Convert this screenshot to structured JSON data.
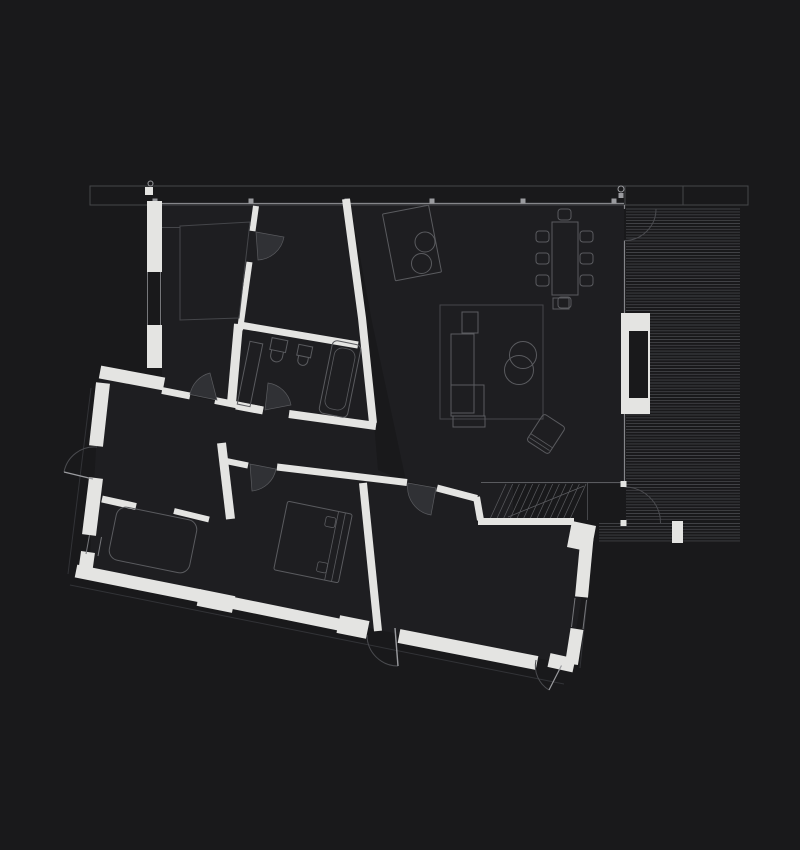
{
  "scene": {
    "kind": "architectural-floor-plan",
    "width": 800,
    "height": 850,
    "style": "dark background, white walls, thin grey furniture outlines, no text labels"
  },
  "palette": {
    "background": "#19191b",
    "floor": "#1e1e21",
    "wall": "#e4e4e2",
    "furniture_line": "#5a5b5f",
    "faint_line": "#45464a",
    "glass_line": "#85868a",
    "window_line": "#76777b",
    "door_arc": "#4a4b4f",
    "door_leaf_fill": "#303135",
    "deck_board": "#404145",
    "mullion": "#9a9b9f",
    "overhang_line": "#323337"
  },
  "glazing": {
    "mullion_xs": [
      155,
      251,
      347,
      432,
      523,
      614
    ],
    "mullion_y": 201,
    "mullion_size": 5
  },
  "deck": {
    "boards_upper": {
      "x0": 626,
      "x1": 740,
      "y0": 209,
      "y1": 520,
      "step": 2.9
    },
    "boards_lower": {
      "x0": 599,
      "x1": 740,
      "y0": 523.5,
      "y1": 542.5,
      "step": 2.9
    }
  },
  "stairs": {
    "x0": 506,
    "x1": 586,
    "y_top": 484,
    "y_bottom": 519,
    "tread_count": 13,
    "tread_slant": 16
  },
  "furniture": {
    "dining": {
      "table": [
        552,
        222,
        26,
        73
      ],
      "chair_size": [
        13,
        11
      ],
      "chairs": [
        [
          536,
          231
        ],
        [
          536,
          253
        ],
        [
          536,
          275
        ],
        [
          580,
          231
        ],
        [
          580,
          253
        ],
        [
          580,
          275
        ],
        [
          558,
          209
        ],
        [
          558,
          297
        ]
      ]
    },
    "inventory": [
      "kitchen-island",
      "island-stools",
      "dining-table",
      "dining-chairs",
      "rug",
      "sectional-sofa",
      "coffee-tables",
      "armchair",
      "side-table",
      "double-bed",
      "pillows",
      "couch",
      "bathtub",
      "toilet",
      "bidet",
      "vanity-counter",
      "closet",
      "stairs",
      "deck",
      "fireplace"
    ]
  },
  "counts": {
    "dining_chairs": 8,
    "island_stools": 2,
    "coffee_tables": 2,
    "door_swings": 10,
    "glazing_mullions": 6,
    "stair_treads": 13
  }
}
